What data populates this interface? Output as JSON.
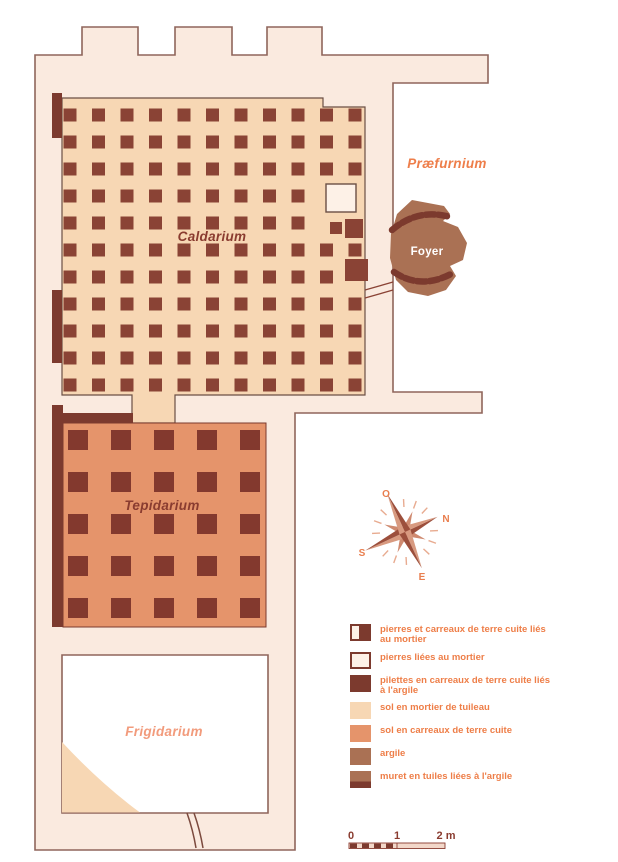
{
  "rooms": {
    "caldarium": {
      "label": "Caldarium"
    },
    "tepidarium": {
      "label": "Tepidarium"
    },
    "frigidarium": {
      "label": "Frigidarium"
    },
    "praefurnium": {
      "label": "Præfurnium"
    },
    "foyer": {
      "label": "Foyer"
    }
  },
  "compass": {
    "north": "N",
    "south": "S",
    "east": "E",
    "west": "O"
  },
  "scale_bar": {
    "ticks": [
      "0",
      "1",
      "2 m"
    ]
  },
  "legend": {
    "items": [
      {
        "swatch": "split",
        "label": "pierres et carreaux de terre cuite liés au mortier"
      },
      {
        "swatch": "outline",
        "label": "pierres liées au mortier"
      },
      {
        "swatch": "solid-dark",
        "label": "pilettes en carreaux de terre cuite liés à l'argile"
      },
      {
        "swatch": "mortar-floor",
        "label": "sol en mortier de tuileau"
      },
      {
        "swatch": "tile-floor",
        "label": "sol en carreaux de terre cuite"
      },
      {
        "swatch": "clay",
        "label": "argile"
      },
      {
        "swatch": "clay-muret",
        "label": "muret en tuiles liées à l'argile"
      }
    ]
  },
  "colors": {
    "wall_fill": "#faeadf",
    "wall_stroke": "#8f655b",
    "mortar_floor": "#f7d7b4",
    "tile_floor": "#e5946b",
    "pilette": "#8a4335",
    "muret": "#7c3a2e",
    "clay": "#aa7154",
    "label_dark": "#8a3c30",
    "label_orange": "#ee7e4a",
    "label_salmon": "#f29b7c",
    "legend_text": "#ee7e48"
  },
  "plan": {
    "grids": [
      {
        "name": "caldarium-pilettes",
        "target": "g-caldarium-grid",
        "cols": 11,
        "rows": 11,
        "x0": 70,
        "y0": 115,
        "dx": 28.5,
        "dy": 27,
        "size": 13,
        "fill": "#8a4335",
        "skip": [
          "4,10",
          "4,11",
          "5,10",
          "5,11",
          "7,11"
        ]
      },
      {
        "name": "tepidarium-tiles",
        "target": "g-tepidarium-grid",
        "cols": 5,
        "rows": 5,
        "x0": 78,
        "y0": 440,
        "dx": 43,
        "dy": 42,
        "size": 20,
        "fill": "#83392e",
        "skip": []
      }
    ]
  }
}
